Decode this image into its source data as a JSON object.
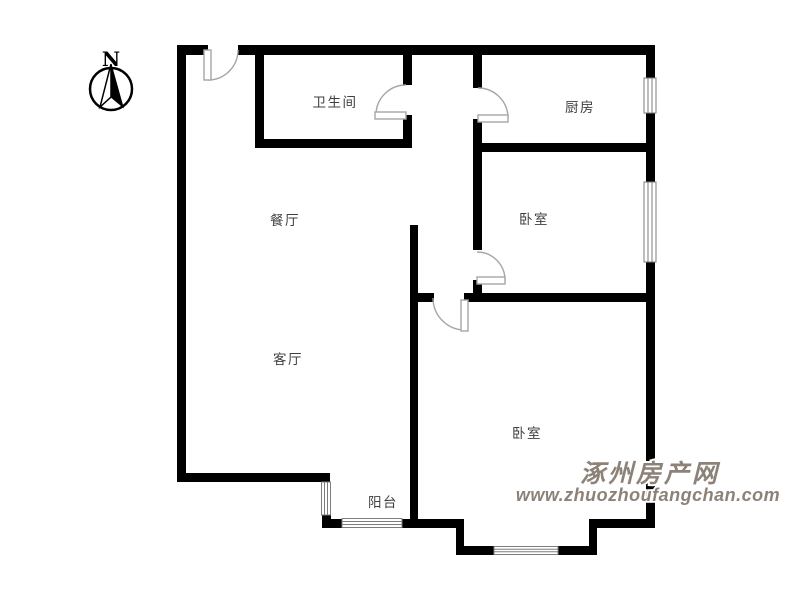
{
  "compass": {
    "label": "N"
  },
  "rooms": {
    "bathroom": {
      "label": "卫生间"
    },
    "kitchen": {
      "label": "厨房"
    },
    "bedroom_top": {
      "label": "卧室"
    },
    "dining": {
      "label": "餐厅"
    },
    "living": {
      "label": "客厅"
    },
    "bedroom_bottom": {
      "label": "卧室"
    },
    "balcony": {
      "label": "阳台"
    }
  },
  "watermark": {
    "site_name": "涿州房产网",
    "site_url": "www.zhuozhoufangchan.com"
  },
  "colors": {
    "wall": "#000000",
    "door_window": "#a6a6a6",
    "room_label": "#3f3f3f",
    "watermark_fill": "#8d8278",
    "watermark_outline": "#ffffff",
    "background": "#ffffff"
  }
}
